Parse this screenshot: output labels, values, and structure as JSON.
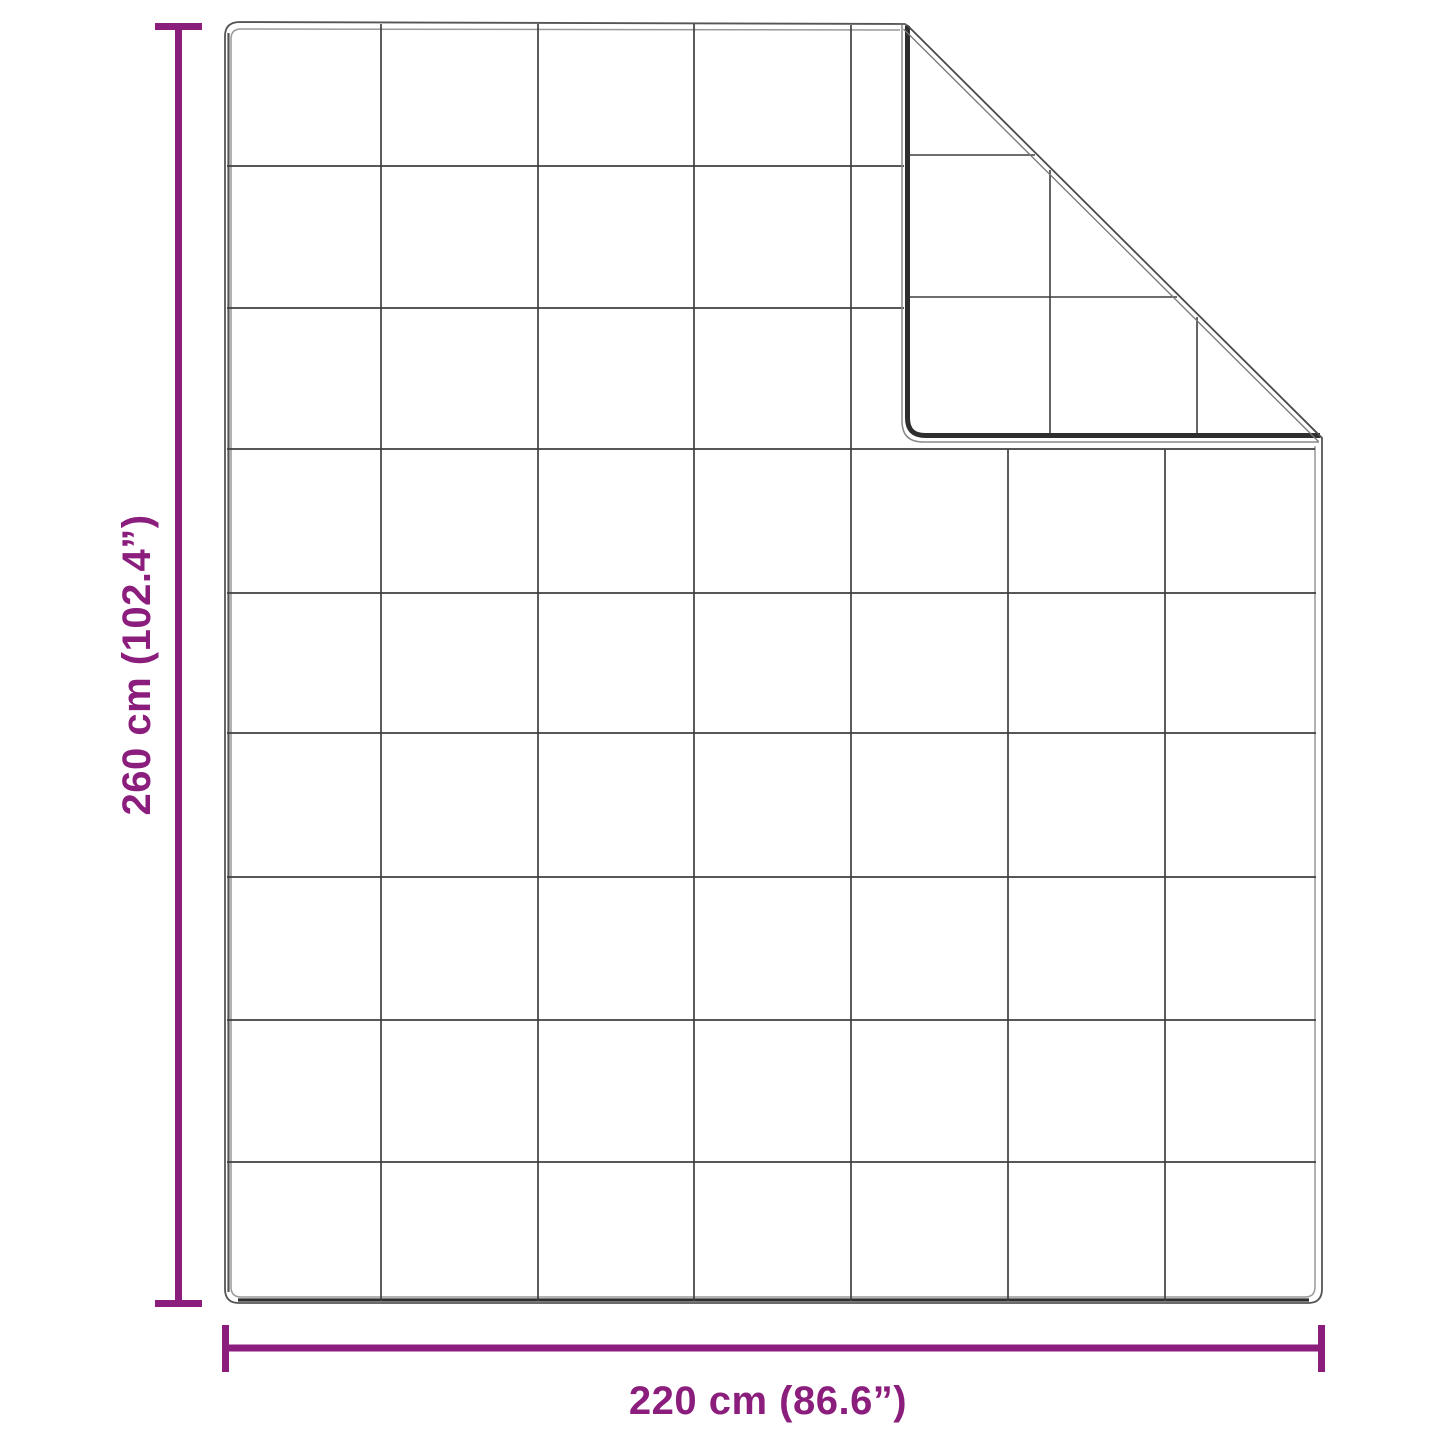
{
  "diagram": {
    "height_label": "260 cm (102.4”)",
    "width_label": "220 cm (86.6”)",
    "colors": {
      "accent": "#8B1E7D",
      "line": "#3F3F3F",
      "edge_dark": "#2E2E2E",
      "edge_light": "#999999",
      "background": "#FFFFFF"
    },
    "quilt_grid": {
      "columns": 7,
      "rows": 9,
      "folded_corner": "top-right"
    }
  }
}
